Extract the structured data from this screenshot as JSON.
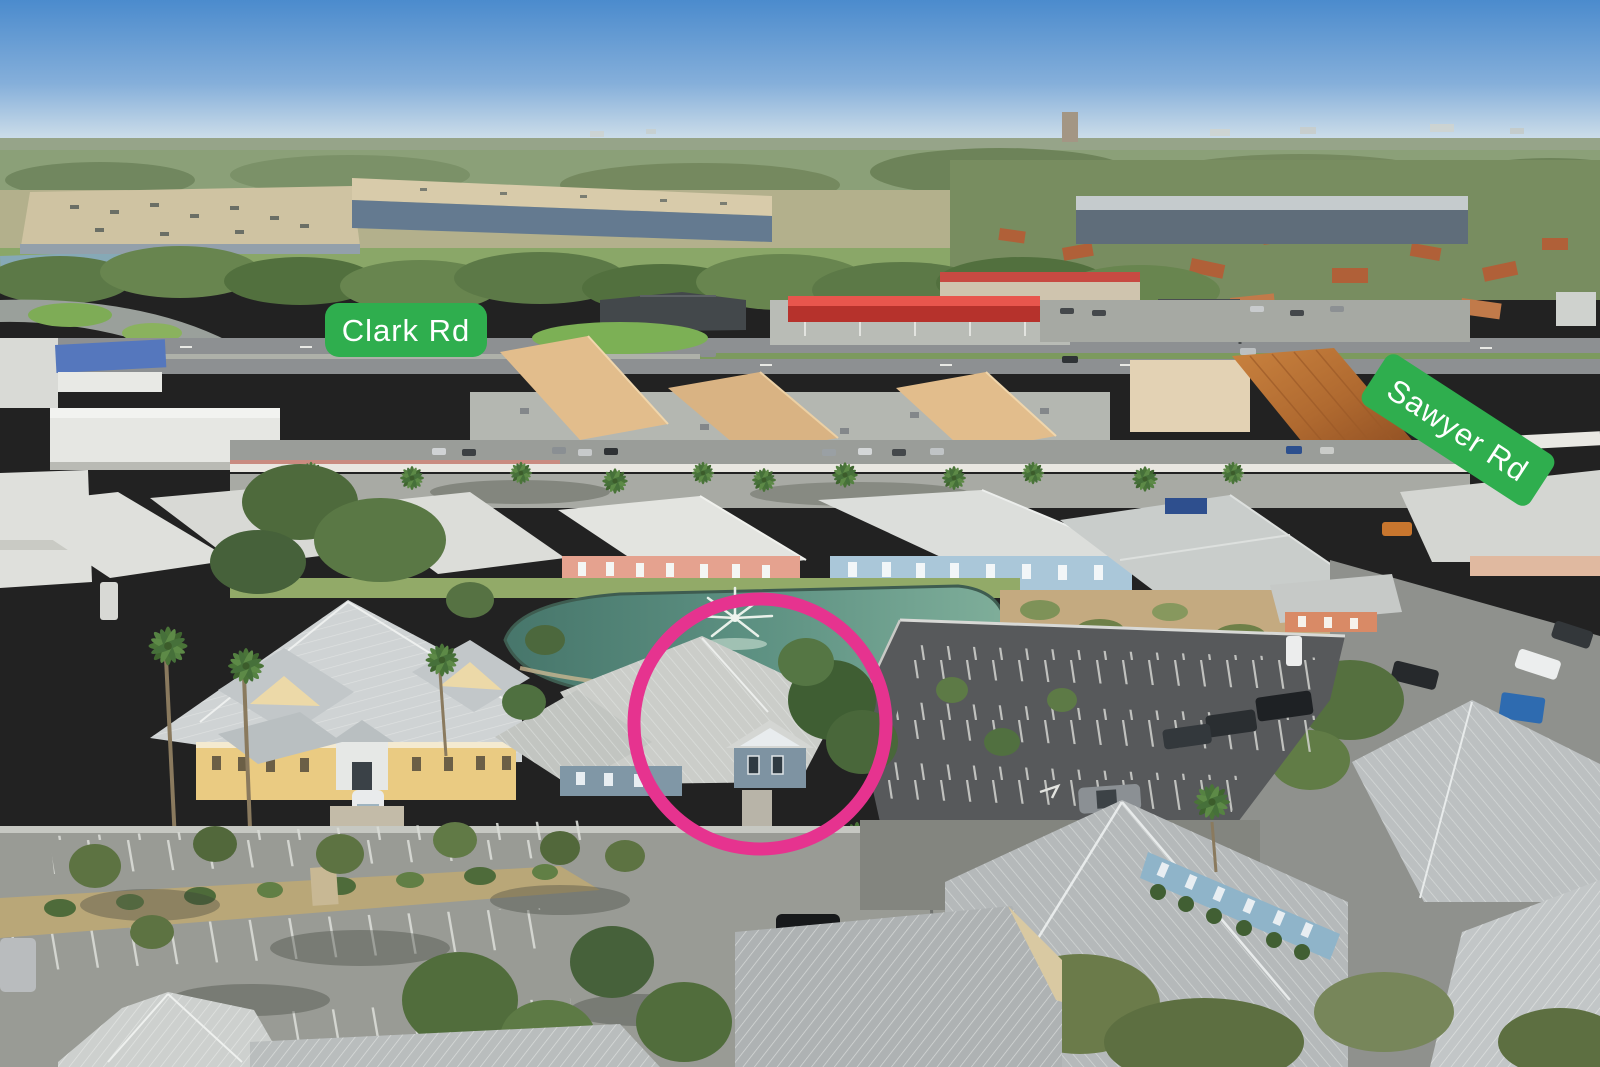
{
  "annotations": {
    "road_labels": [
      {
        "id": "clark",
        "label": "Clark Rd"
      },
      {
        "id": "sawyer",
        "label": "Sawyer Rd"
      }
    ],
    "colors": {
      "label_bg": "#2fae4e",
      "label_text": "#ffffff",
      "highlight_circle": "#e6338f",
      "sky_top": "#4b8bcd",
      "pond_teal": "#5d9182"
    }
  }
}
